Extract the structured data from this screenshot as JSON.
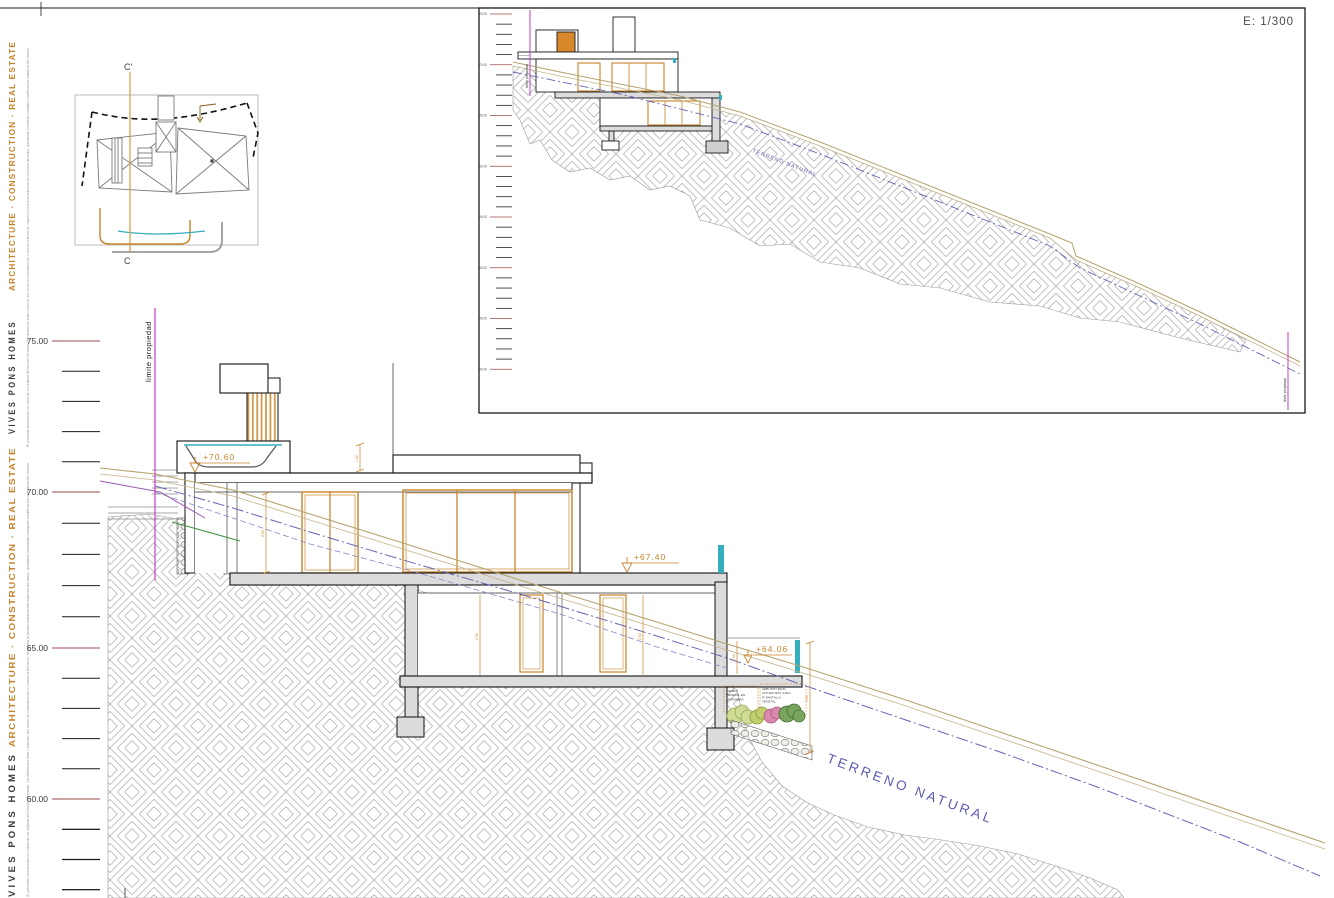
{
  "branding": {
    "company": "VIVES PONS HOMES",
    "tagline": "ARCHITECTURE · CONSTRUCTION · REAL ESTATE",
    "disclaimer": "El presente documento es copia de su original del técnico firmante. Su utilización total o parcial, así como su reproducción o cesión a terceros, requerirá la previa autorización expresa del autor, quedando prohibida cualquier modificación unilateral del mismo."
  },
  "site_plan": {
    "section_mark_top": "C'",
    "section_mark_bottom": "C"
  },
  "inset": {
    "scale_label": "E: 1/300",
    "elevation_labels": [
      "75.00",
      "70.00",
      "65.00",
      "60.00",
      "55.00",
      "50.00",
      "45.00",
      "40.00"
    ],
    "terrain_label": "TERRENO NATURAL",
    "boundary_label_left": "limite propiedad",
    "boundary_label_right": "limite propiedad"
  },
  "main_section": {
    "elevation_labels": [
      "75.00",
      "70.00",
      "65.00",
      "60.00"
    ],
    "boundary_label": "limite propiedad",
    "terrain_label": "TERRENO NATURAL",
    "levels": {
      "upper_terrace": "+70.60",
      "main_terrace": "+67.40",
      "lower_terrace": "+64.06"
    },
    "dims": {
      "pool_depth": "1.00",
      "upper_height": "2.50",
      "lower_height_a": "2.60",
      "lower_height_b": "2.60",
      "terrace_height": "1.00",
      "slope_height": "3.60"
    },
    "planter_notes": {
      "left": [
        "TIERRA",
        "VEGETAL EN",
        "JARDINERA"
      ],
      "right": [
        "ARBUSTO BAJO",
        "ALTURA MÁX 1,00m",
        "P/ PANTALLA",
        "VEGETAL"
      ]
    }
  },
  "colors": {
    "accent_orange": "#c8832a",
    "boundary_magenta": "#c43fc4",
    "water_teal": "#35aec0",
    "terrain_blue": "#5c5cb0",
    "terrain_tan": "#b5a36e",
    "tick_red": "#9b4b4b",
    "hatch_grey": "#a3a3a3"
  }
}
